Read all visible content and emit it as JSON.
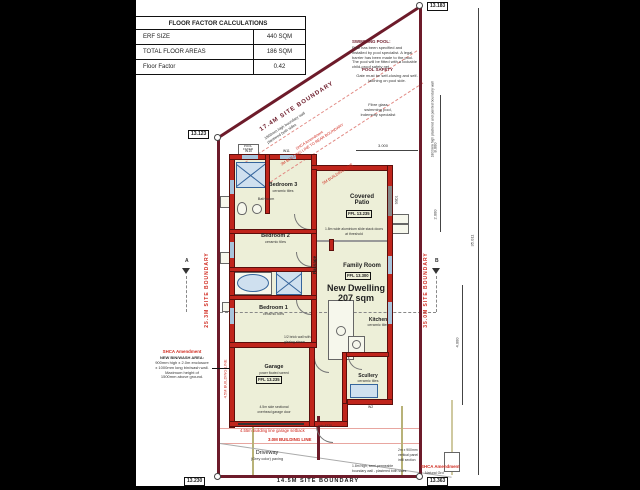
{
  "title_block": {
    "header": "FLOOR FACTOR CALCULATIONS",
    "rows": [
      {
        "label": "ERF SIZE",
        "value": "440 SQM"
      },
      {
        "label": "TOTAL FLOOR AREAS",
        "value": "186 SQM"
      },
      {
        "label": "Floor Factor",
        "value": "0.42"
      }
    ]
  },
  "boundary": {
    "top": "17.4M SITE BOUNDARY",
    "left": "25.3M SITE BOUNDARY",
    "right": "35.0M SITE BOUNDARY",
    "bottom": "14.5M SITE BOUNDARY"
  },
  "levels": {
    "top_left": "13.123",
    "top_right": "13.183",
    "bottom_left": "13.230",
    "bottom_right": "13.363",
    "bottom_right_note": "Natural Grd"
  },
  "rooms": {
    "bedroom3": {
      "name": "Bedroom 3",
      "finish": "ceramic tiles"
    },
    "bathroom": {
      "name": "Bathroom",
      "finish": "ceramic tiles"
    },
    "bedroom2": {
      "name": "Bedroom 2",
      "finish": "ceramic tiles"
    },
    "bedroom1": {
      "name": "Bedroom 1",
      "finish": "ceramic tiles"
    },
    "covered_patio": {
      "name": "Covered\nPatio",
      "ffl": "FFL 13.235"
    },
    "family_room": {
      "name": "Family Room",
      "ffl": "FFL 13.300"
    },
    "passage": {
      "name": "Passage"
    },
    "kitchen": {
      "name": "Kitchen",
      "finish": "ceramic tiles"
    },
    "garage": {
      "name": "Garage",
      "finish": "power floated screed",
      "ffl": "FFL 13.235"
    },
    "scullery": {
      "name": "Scullery",
      "finish": "ceramic tiles"
    }
  },
  "dwelling": {
    "label": "New Dwelling\n207 sqm"
  },
  "notes": {
    "swimming_pool_title": "SWIMMING POOL:",
    "swimming_pool_body": "Pool has been specified and installed by pool specialist. A legal barrier has been made to the pool. The pool will be fitted with a lockable child-proof safety net.",
    "pool_safety_title": "POOL SAFETY",
    "pool_safety_body": "Gate must be self-closing and self-latching on pool side.",
    "fibre_glass": "Fibre glass\nswimming pool,\nindemnity specialist",
    "boundary_wall": "1800mm high boundary wall\nplastered both sides",
    "diag_line_1": "SHCA Amendment\n3M BUILDING LINE TO REAR BOUNDARY",
    "diag_line_2": "5M BUILDING LINE",
    "right_wall_note": "1800mm high plastered and painted boundary wall",
    "bin_title": "SHCA Amendment",
    "bin_heading": "NEW BIN/WASH AREA:",
    "bin_body": "900mm high x 2.0m enclosure\nx 1000mm long bin/wash wall.\nMaximum height of\n1500mm above ground.",
    "left_building_line": "4.5M BUILDING LINE",
    "garage_door": "4.5m side sectional\noverhead garage door",
    "garage_setback": "4.55m building line garage setback",
    "building_line_3m": "3.0M BUILDING LINE",
    "min_clear": "min 4270",
    "driveway": "Driveway",
    "driveway_sub": "(Grey color) paving",
    "half_brick": "1/2 brick wall with\nglazing above",
    "slide_doors": "1.8m wide aluminium slide stack doors\nat threshold",
    "wall_bottom": "1.8m high, semi-permeable\nboundary wall - plastered both sides",
    "infill": "2m x 900mm\nvertical panel\ninfill section",
    "shca_bottom": "SHCA Amendment",
    "pool_filter": "POOL\nFILTER"
  },
  "dims": {
    "d35": "35.011",
    "d8": "8.000",
    "d2": "2.000",
    "d4": "4.000",
    "d3": "3.000",
    "section_b": "B",
    "section_a": "A"
  },
  "windows": {
    "w10": "W10",
    "w11": "W11",
    "ssd1": "SSD1",
    "w2": "W2"
  },
  "colors": {
    "wall_red": "#c0251c",
    "boundary_maroon": "#6d1b2a",
    "room_fill": "#edefd8",
    "note_red": "#d02a1f",
    "fixture_blue": "#35659c",
    "service_olive": "#b8b278"
  }
}
